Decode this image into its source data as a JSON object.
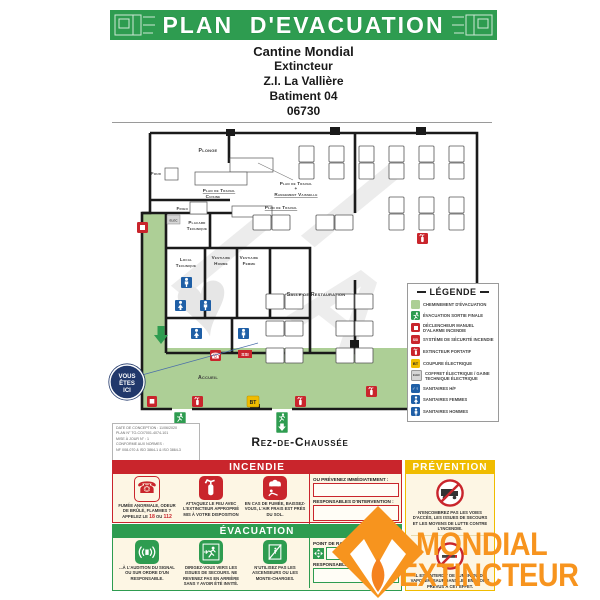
{
  "banner": {
    "title": "PLAN  D'EVACUATION"
  },
  "site": {
    "lines": [
      "Cantine Mondial",
      "Extincteur",
      "Z.I. La Vallière",
      "Batiment 04",
      "06730"
    ]
  },
  "plan": {
    "floor": "Rez-de-Chaussée",
    "you_are_here": {
      "l1": "VOUS",
      "l2": "ÊTES",
      "l3": "ICI"
    },
    "labels": [
      "Plonge",
      "Four",
      "Plan de Travail",
      "Cuisine",
      "Frigo",
      "Placard",
      "Technique",
      "Plan de Travail",
      "+",
      "Rangement Vaisselle",
      "Plan de Travail",
      "Local",
      "Technique",
      "Vestiaire",
      "Homme",
      "Vestiaire",
      "Femme",
      "Salle de Restauration",
      "Accueil"
    ],
    "icon_texts": {
      "ssi": "SSI",
      "bt": "BT",
      "elec": "ELEC"
    },
    "info_box": {
      "lines": [
        "DATE DE CONCEPTION : 11/06/2020",
        "PLAN N° TO-CO/7001-4074-101",
        "MISE À JOUR N° : 1",
        "CONFORME AUX NORMES :",
        "NF X08-070 & ISO 3864-1 & ISO 3864-3"
      ]
    }
  },
  "legend": {
    "title": "LÉGENDE",
    "items": [
      "CHEMINEMENT D'ÉVACUATION",
      "ÉVACUATION SORTIE FINALE",
      "DÉCLENCHEUR MANUEL D'ALARME INCENDIE",
      "SYSTÈME DE SÉCURITÉ INCENDIE",
      "EXTINCTEUR PORTATIF",
      "COUPURE ÉLECTRIQUE",
      "COFFRET ÉLECTRIQUE / GAINE TECHNIQUE ÉLECTRIQUE",
      "SANITAIRES H/F",
      "SANITAIRES FEMMES",
      "SANITAIRES HOMMES"
    ],
    "icon_texts": {
      "ssi": "SSI",
      "bt": "BT",
      "elec": "ELEC"
    }
  },
  "incendie": {
    "title": "INCENDIE",
    "step1_text": "FUMÉE ANORMALE, ODEUR DE BRÛLÉ, FLAMMES ?",
    "step1_call": "APPELEZ LE ",
    "step1_num1": "18",
    "step1_or": " OU ",
    "step1_num2": "112",
    "step2": "ATTAQUEZ LE FEU AVEC L'EXTINCTEUR APPROPRIÉ MIS À VOTRE DISPOSITION",
    "step3": "EN CAS DE FUMÉE, BAISSEZ-VOUS, L'AIR FRAIS EST PRÈS DU SOL.",
    "notify_label": "OU PRÉVENEZ IMMÉDIATEMENT :",
    "resp_label": "RESPONSABLES D'INTERVENTION :"
  },
  "evacuation_panel": {
    "title": "ÉVACUATION",
    "step1": "...À L'AUDITION DU SIGNAL OU SUR ORDRE D'UN RESPONSABLE.",
    "step2": "DIRIGEZ-VOUS VERS LES ISSUES DE SECOURS. NE REVENEZ PAS EN ARRIÈRE SANS Y AVOIR ÉTÉ INVITÉ.",
    "step3": "N'UTILISEZ PAS LES ASCENSEURS OU LES MONTE-CHARGES.",
    "point_label": "POINT DE RASSEMBLEMENT",
    "resp_label": "RESPONSABLES D'ÉVACUATION :"
  },
  "prevention": {
    "title": "PRÉVENTION",
    "item1": "N'ENCOMBREZ PAS LES VOIES D'ACCÈS, LES ISSUES DE SECOURS ET LES MOYENS DE LUTTE CONTRE L'INCENDIE.",
    "item2": "IL EST INTERDIT DE FUMER OU DE VAPOTER, SAUF DANS LES ENDROITS PRÉVUS À CET EFFET."
  },
  "brand": {
    "line1": "MONDIAL",
    "line2": "EXTINCTEUR"
  },
  "colors": {
    "green": "#2e9c50",
    "light_green": "#adcf96",
    "red": "#c9252c",
    "yellow": "#f0bc00",
    "blue": "#1f5fa6",
    "navy": "#21386b",
    "orange": "#f7941e",
    "cream": "#fdf6e4"
  }
}
